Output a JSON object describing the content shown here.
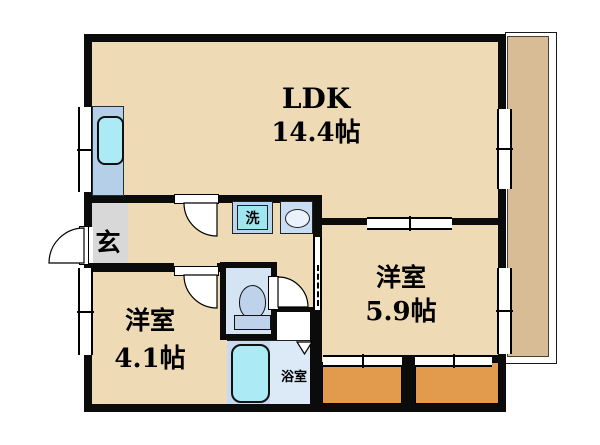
{
  "plan": {
    "type": "japanese-apartment-floor-plan",
    "rooms": {
      "ldk": {
        "name": "LDK",
        "area": "14.4帖"
      },
      "bedroom_right": {
        "name": "洋室",
        "area": "5.9帖"
      },
      "bedroom_left": {
        "name": "洋室",
        "area": "4.1帖"
      },
      "entrance": {
        "name": "玄"
      },
      "laundry": {
        "name": "洗"
      },
      "bathroom": {
        "name": "浴室"
      }
    },
    "fixtures": [
      "kitchen-sink",
      "washing-machine",
      "washbasin",
      "toilet",
      "bathtub",
      "balcony",
      "closet",
      "closet"
    ],
    "colors": {
      "room_fill": "#eedbb6",
      "balcony_fill": "#d8bc96",
      "closet_fill": "#e29a4d",
      "entrance_fill": "#d8d8d8",
      "fixture_blue": "#b6cfe9",
      "water_cyan": "#aceaf5",
      "toilet_room_fill": "#d5e4f3",
      "bath_fill": "#dce9f6",
      "wall": "#000000"
    }
  }
}
